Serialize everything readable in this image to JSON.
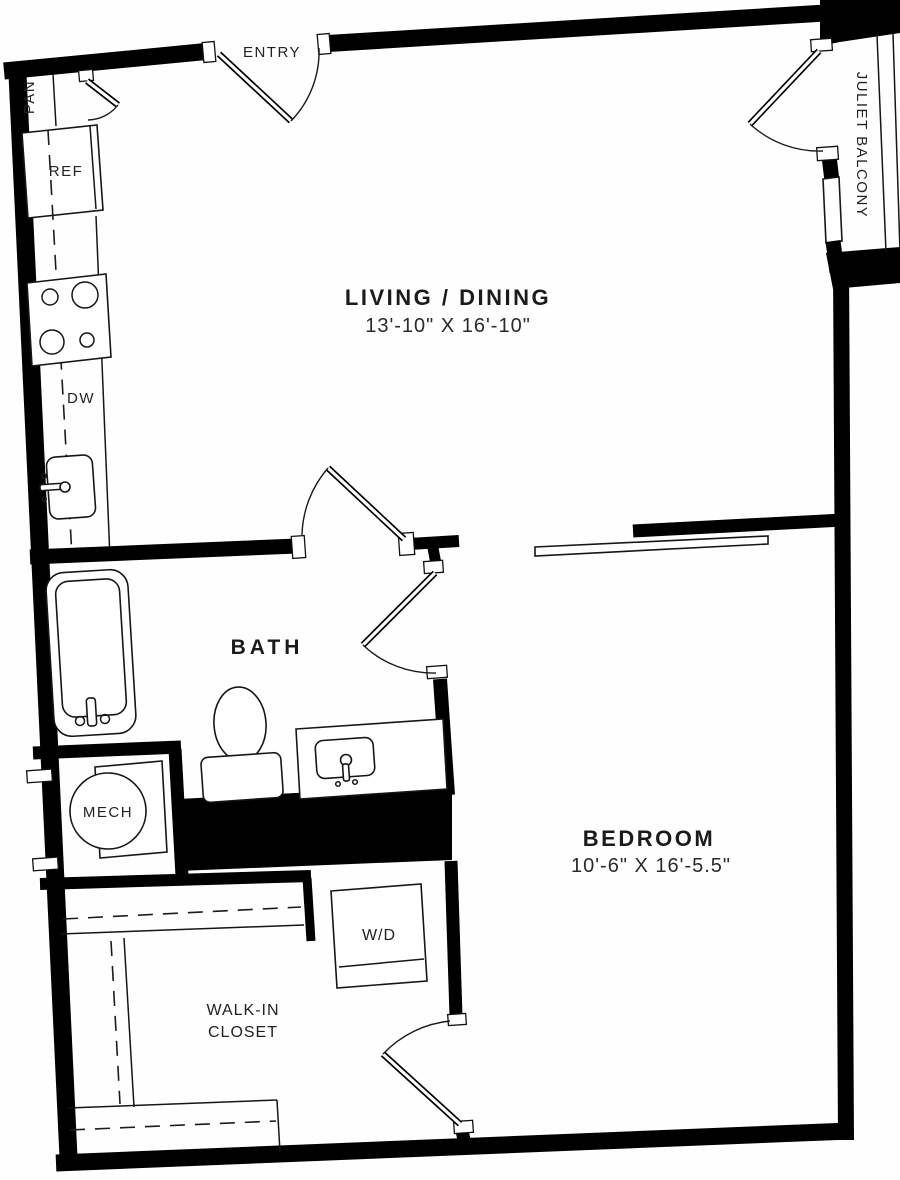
{
  "plan": {
    "rooms": {
      "living_dining": {
        "name": "LIVING / DINING",
        "dims": "13'-10\" X 16'-10\""
      },
      "bedroom": {
        "name": "BEDROOM",
        "dims": "10'-6\" X 16'-5.5\""
      },
      "bath": {
        "name": "BATH"
      },
      "walk_in_closet": {
        "name_line1": "WALK-IN",
        "name_line2": "CLOSET"
      },
      "mech": {
        "name": "MECH"
      }
    },
    "labels": {
      "entry": "ENTRY",
      "pantry": "PAN",
      "refrigerator": "REF",
      "dishwasher": "DW",
      "washer_dryer": "W/D",
      "juliet_balcony": "JULIET BALCONY"
    },
    "colors": {
      "wall": "#000000",
      "background": "#ffffff",
      "line": "#1a1a1a"
    }
  }
}
